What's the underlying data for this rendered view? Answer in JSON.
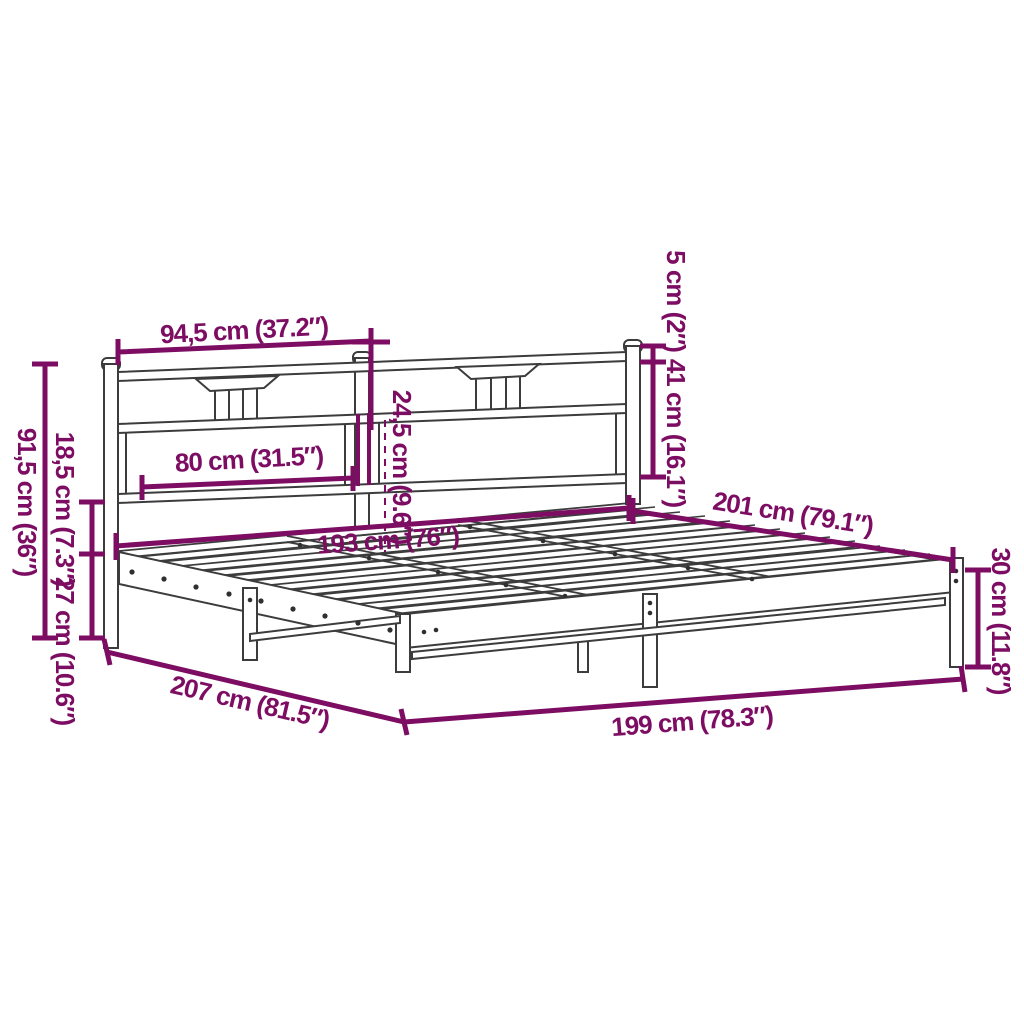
{
  "figure": {
    "subject": "bed frame dimension drawing",
    "units": "centimetres with inches in parentheses"
  },
  "colors": {
    "dimension_annotation": "#7D0D63",
    "drawing_line": "#3C3C3C",
    "background": "#FFFFFF"
  },
  "dimensions": {
    "headboard_section_width": "94,5 cm (37.2″)",
    "post_top_height": "5 cm (2″)",
    "headboard_upper_height": "41 cm (16.1″)",
    "headboard_total_height": "91,5 cm (36″)",
    "under_headboard_gap": "18,5 cm (7.3″)",
    "platform_height": "27 cm (10.6″)",
    "headboard_panel_width": "80 cm (31.5″)",
    "headboard_drop": "24,5 cm (9.6″)",
    "slat_area_width": "193 cm (76″)",
    "frame_length_top": "201 cm (79.1″)",
    "foot_end_height": "30 cm (11.8″)",
    "floor_length": "207 cm (81.5″)",
    "overall_width": "199 cm (78.3″)"
  }
}
